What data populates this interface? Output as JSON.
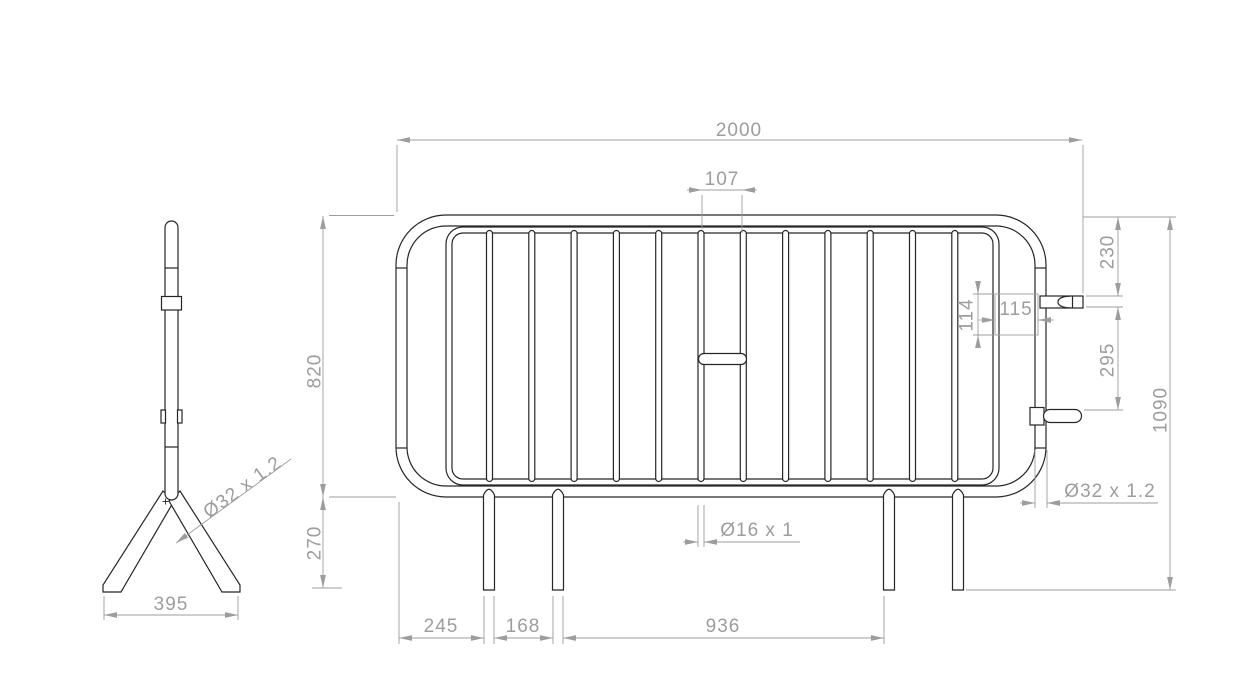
{
  "drawing": {
    "description": "Crowd control barrier technical drawing, side view and front view",
    "dimensions": {
      "overall_length": "2000",
      "center_bar_gap": "107",
      "frame_height": "820",
      "ground_clearance": "270",
      "total_height": "1090",
      "hook_top_offset": "230",
      "hook_spacing": "295",
      "bracket_height": "114",
      "bracket_width": "115",
      "foot_width": "395",
      "leg_offset": "245",
      "leg_gap": "168",
      "leg_span": "936",
      "infill_tube_spec": "Ø16 x 1",
      "frame_tube_spec": "Ø32 x 1.2"
    },
    "colors": {
      "part_line": "#262626",
      "dimension_line": "#9d9d9d",
      "background": "#ffffff"
    }
  }
}
